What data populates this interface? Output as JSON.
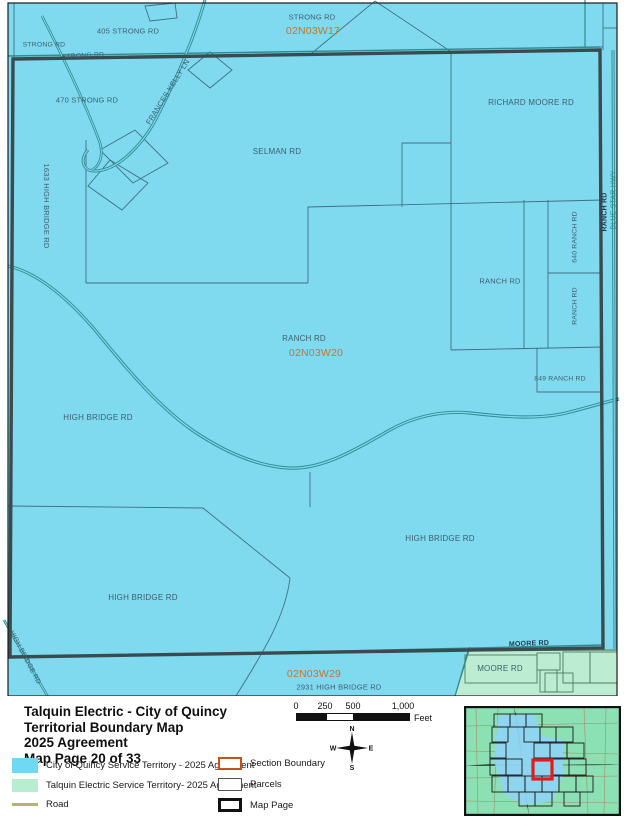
{
  "colors": {
    "quincy_territory": "#7FD9EF",
    "talquin_territory": "#BCEDD3",
    "road_legend_line": "#B5B273",
    "road_line": "#2F8C91",
    "section_label_text": "#C8742F",
    "boundary_line": "#394B4F",
    "current_page_red": "#E61A1A"
  },
  "map": {
    "labels": {
      "strong_rd_nw": "STRONG RD",
      "strong_rd_405": "405 STRONG RD",
      "strong_rd_boundary": "STRONG RD",
      "strong_rd_top": "STRONG RD",
      "section_nw": "02N03W17",
      "strong_rd_470": "470 STRONG RD",
      "frances_kelly_ln": "FRANCES KELLY LN",
      "richard_moore_rd": "RICHARD MOORE RD",
      "selman_rd": "SELMAN RD",
      "high_bridge_1633": "1633 HIGH BRIDGE RD",
      "ranch_rd_parcel": "RANCH RD",
      "ranch_rd_640": "640 RANCH RD",
      "ranch_rd_v": "RANCH RD",
      "ranch_rd_center": "RANCH RD",
      "section_center": "02N03W20",
      "ranch_rd_849": "849 RANCH RD",
      "high_bridge_w": "HIGH BRIDGE RD",
      "high_bridge_e": "HIGH BRIDGE RD",
      "high_bridge_s": "HIGH BRIDGE RD",
      "high_bridge_diag": "HIGH BRIDGE RD",
      "moore_rd_road": "MOORE RD",
      "moore_rd_green": "MOORE RD",
      "section_sw": "02N03W29",
      "high_bridge_2931": "2931 HIGH BRIDGE RD",
      "ranch_rd_edge": "RANCH RD",
      "blue_star_hwy": "BLUE STAR HWY"
    }
  },
  "footer": {
    "title_lines": [
      "Talquin Electric - City of Quincy",
      "Territorial Boundary Map",
      "2025 Agreement",
      "Map Page 20 of 33"
    ],
    "scale": {
      "ticks": [
        "0",
        "250",
        "500",
        "1,000"
      ],
      "unit": "Feet"
    },
    "compass": {
      "n": "N",
      "e": "E",
      "s": "S",
      "w": "W"
    },
    "legend": {
      "quincy": "City of Quincy Service Territory - 2025 Agreement",
      "talquin": "Talquin Electric Service Territory- 2025 Agreement",
      "road": "Road",
      "section_boundary": "Section Boundary",
      "parcels": "Parcels",
      "map_page": "Map Page"
    }
  }
}
